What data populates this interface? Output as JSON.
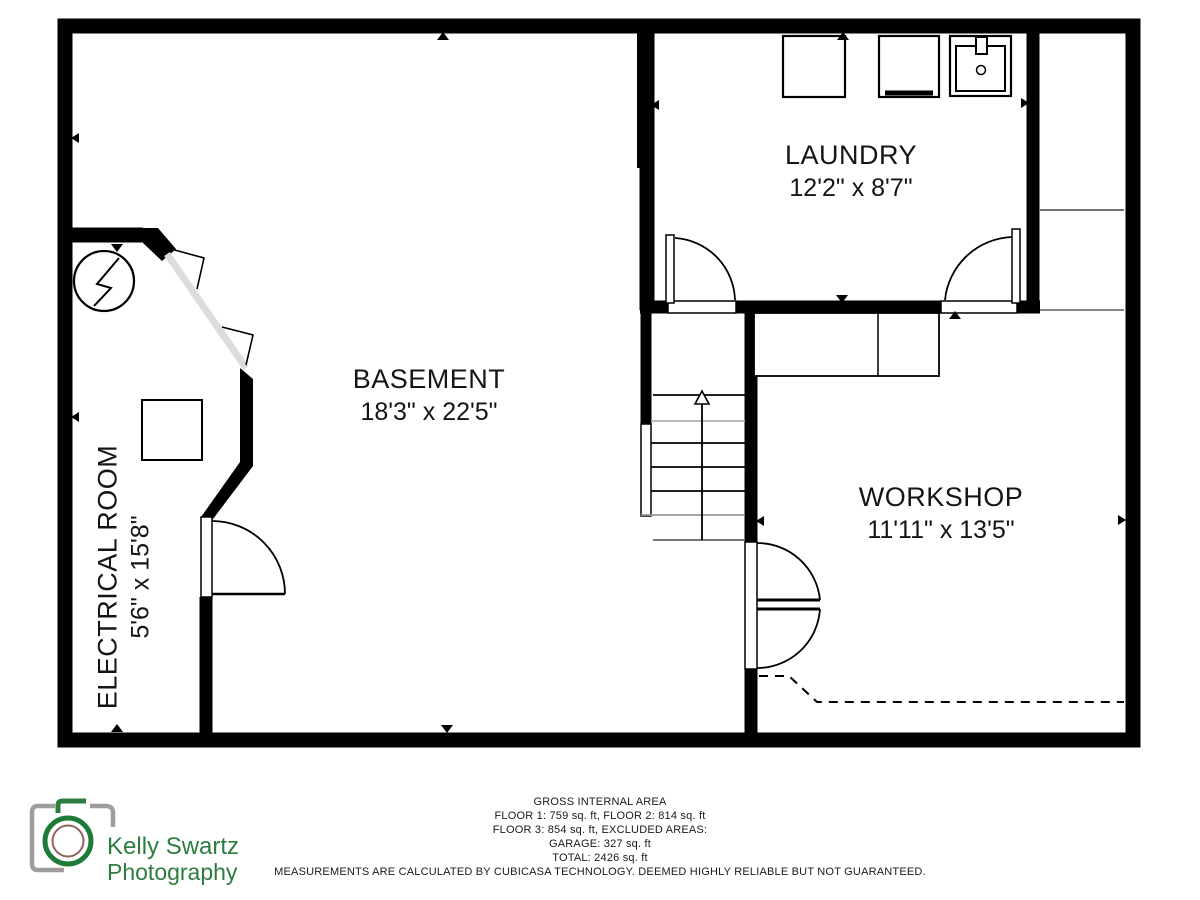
{
  "plan": {
    "rooms": [
      {
        "name": "BASEMENT",
        "dimensions": "18'3\" x 22'5\""
      },
      {
        "name": "LAUNDRY",
        "dimensions": "12'2\" x 8'7\""
      },
      {
        "name": "WORKSHOP",
        "dimensions": "11'11\" x 13'5\""
      },
      {
        "name": "ELECTRICAL ROOM",
        "dimensions": "5'6\" x 15'8\""
      }
    ],
    "icons": [
      "washer-icon",
      "dryer-icon",
      "utility-sink-icon",
      "electrical-panel-icon",
      "stairs-up-arrow-icon"
    ]
  },
  "footer": {
    "area_summary": {
      "title": "GROSS INTERNAL AREA",
      "line1": "FLOOR 1: 759 sq. ft, FLOOR 2: 814 sq. ft",
      "line2": "FLOOR 3: 854 sq. ft, EXCLUDED AREAS:",
      "line3": "GARAGE: 327 sq. ft",
      "line4": "TOTAL: 2426 sq. ft"
    },
    "disclaimer": "MEASUREMENTS ARE CALCULATED BY CUBICASA TECHNOLOGY. DEEMED HIGHLY RELIABLE BUT NOT GUARANTEED."
  },
  "logo": {
    "name_line1": "Kelly Swartz",
    "name_line2": "Photography"
  },
  "colors": {
    "wall": "#000000",
    "logo_green": "#2d7c40",
    "camera_gray": "#9d9d9d",
    "lens_inner_ring": "#8d655d",
    "ghost_wall_gray": "#dcdcdc"
  }
}
